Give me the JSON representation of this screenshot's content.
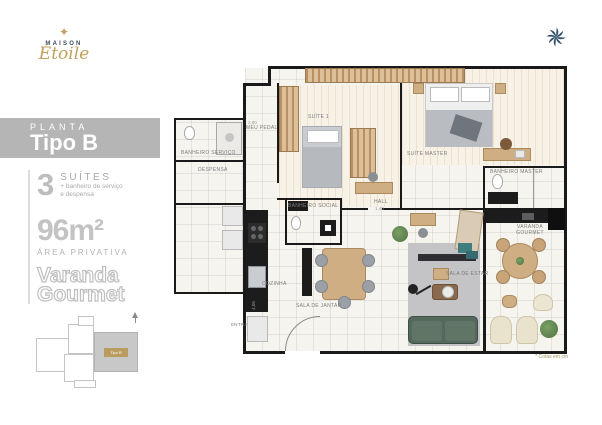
{
  "brand": {
    "star_icon": "✦",
    "name": "MAISON",
    "script": "Étoile"
  },
  "panel": {
    "band": {
      "kicker": "PLANTA",
      "title": "Tipo B"
    },
    "suites": {
      "count": "3",
      "label": "SUÍTES",
      "note_line1": "+ banheiro de serviço",
      "note_line2": "e despensa"
    },
    "area": {
      "value": "96m²",
      "label": "ÁREA PRIVATIVA"
    },
    "feature": {
      "line1": "Varanda",
      "line2": "Gourmet"
    },
    "keyplan": {
      "unit_label": "Tipo B"
    }
  },
  "plan": {
    "rooms": {
      "banheiro_servico": "BANHEIRO SERVIÇO",
      "despensa": "DESPENSA",
      "meu_pedal": "MEU PEDAL",
      "suite_1": "SUÍTE 1",
      "suite_master": "SUÍTE MASTER",
      "banheiro_master": "BANHEIRO MASTER",
      "banheiro_social": "BANHEIRO SOCIAL",
      "hall": "HALL",
      "cozinha": "COZINHA",
      "sala_jantar": "SALA DE JANTAR",
      "sala_estar": "SALA DE ESTAR",
      "varanda_gourmet": "VARANDA GOURMET",
      "entrada": "ENTRADA"
    },
    "dimensions": [
      "2,80",
      "1,40",
      "4,05"
    ],
    "footnote": "* Cotas em cm"
  },
  "colors": {
    "gold": "#c3a05c",
    "navy": "#33506b",
    "band_gray": "#b5b5b5",
    "wall": "#1a1a1a",
    "sofa_green": "#55685c"
  }
}
